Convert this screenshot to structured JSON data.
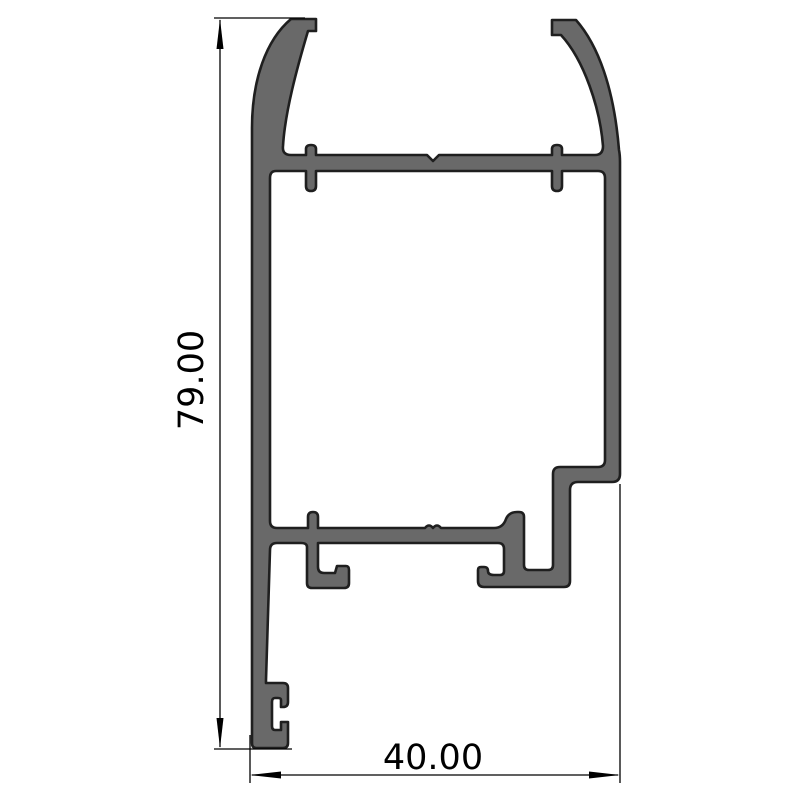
{
  "drawing": {
    "dimensions": {
      "height": {
        "label": "79.00"
      },
      "width": {
        "label": "40.00"
      }
    },
    "colors": {
      "background": "#ffffff",
      "profile_fill": "#696969",
      "profile_outline": "#1f1f1f",
      "dimension_line": "#000000",
      "label_text": "#000000"
    }
  }
}
